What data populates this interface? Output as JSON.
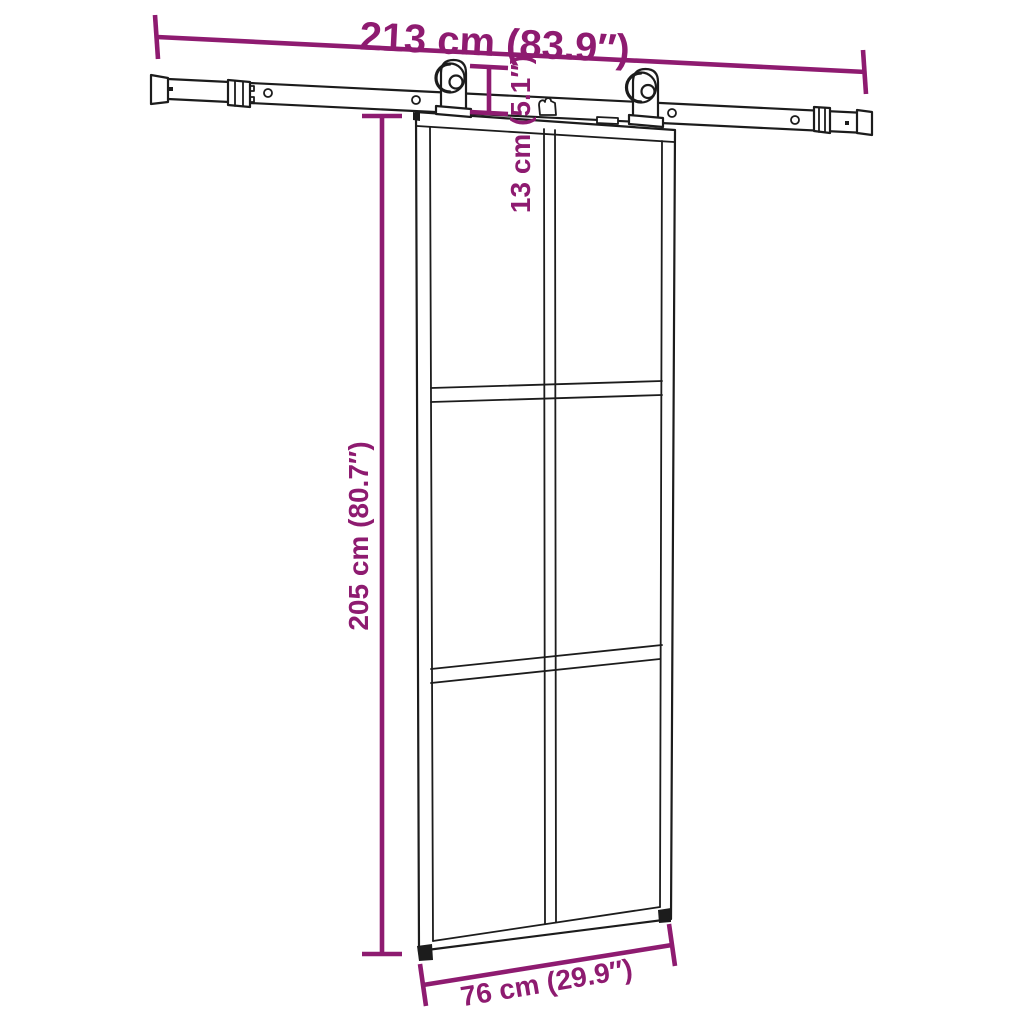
{
  "diagram": {
    "description": "Dimension drawing of a glass sliding barn door with steel sliding hardware track",
    "background_color": "#ffffff",
    "linework_color": "#1c1c1c",
    "dimension_color": "#8E1B70",
    "door": {
      "panes_columns": 2,
      "panes_rows": 3
    },
    "dimensions": {
      "track_length": {
        "label": "213 cm (83.9″)"
      },
      "drop_height": {
        "label": "13 cm (5.1″)"
      },
      "door_height": {
        "label": "205 cm (80.7″)"
      },
      "door_width": {
        "label": "76 cm (29.9″)"
      }
    }
  }
}
